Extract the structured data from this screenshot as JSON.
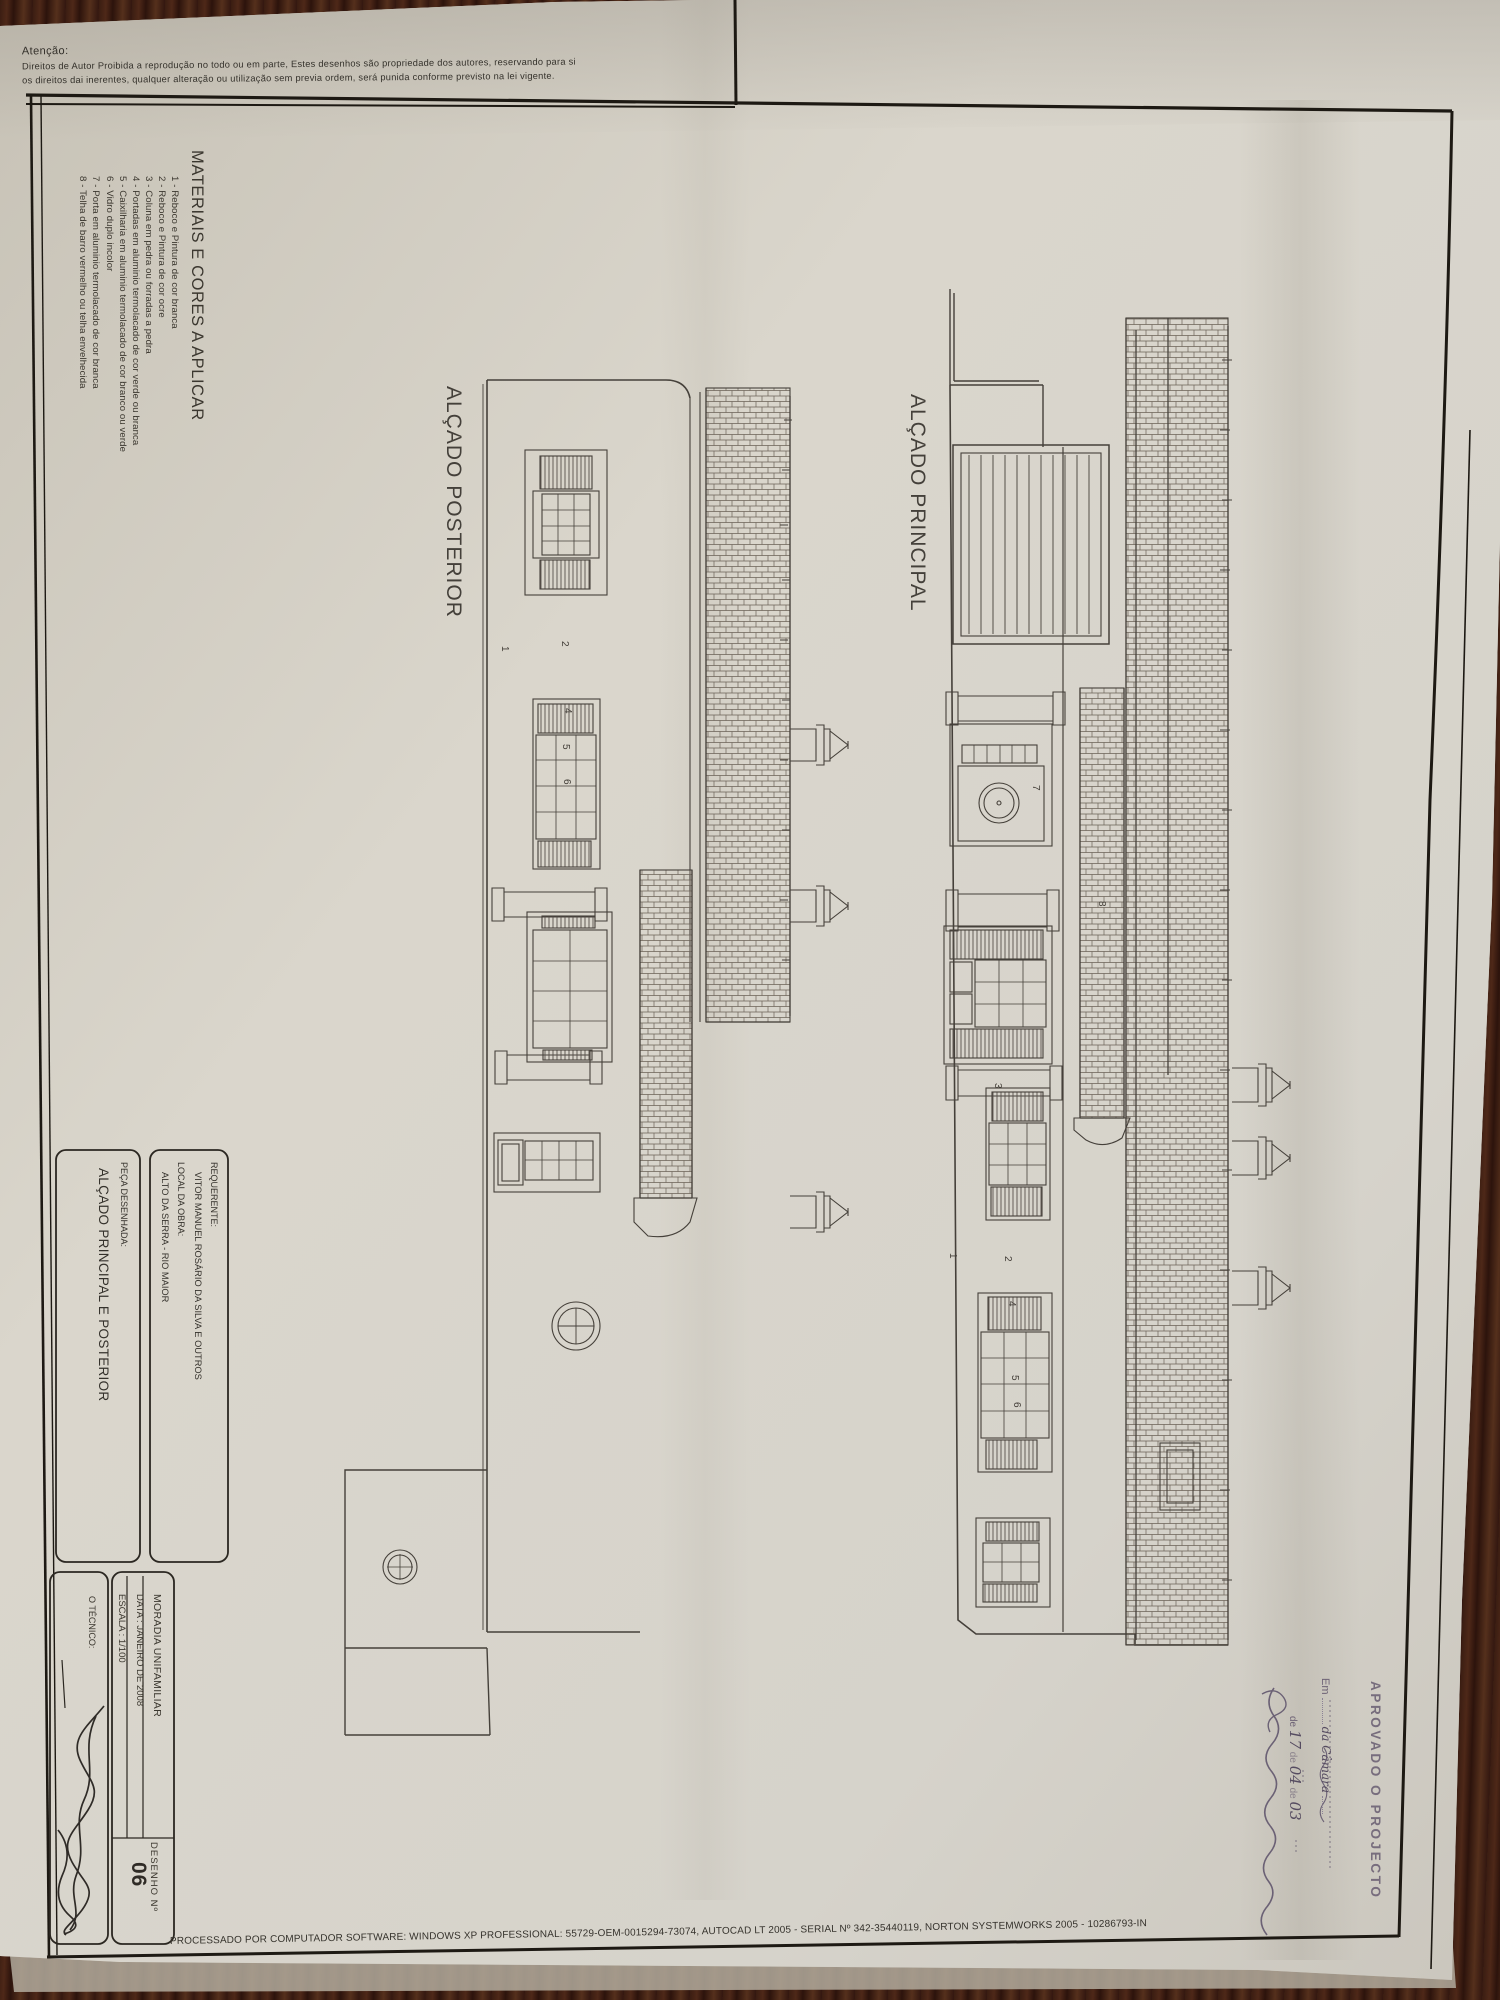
{
  "notice": {
    "heading": "Atenção:",
    "line1": "Direitos de Autor Proibida a reprodução no todo ou em parte, Estes desenhos são propriedade dos autores, reservando para si",
    "line2": "os direitos dai inerentes, qualquer alteração ou utilização sem previa ordem, será punida conforme previsto na lei vigente."
  },
  "materials": {
    "title": "MATERIAIS E CORES A APLICAR",
    "items": [
      "1 - Reboco e Pintura de cor branca",
      "2 - Reboco e Pintura de cor ocre",
      "3 - Coluna em pedra ou forradas a pedra",
      "4 - Portadas em aluminio termolacado de cor verde ou branca",
      "5 - Caixilharia em aluminio termolacado de cor branco ou verde",
      "6 - Vidro duplo incolor",
      "7 - Porta em aluminio termolacado de cor branca",
      "8 - Telha de barro vermelho ou telha envelhecida"
    ]
  },
  "elevations": {
    "posterior_label": "ALÇADO POSTERIOR",
    "principal_label": "ALÇADO PRINCIPAL"
  },
  "drawing_refs": {
    "posterior": [
      "1",
      "2",
      "4",
      "5",
      "6"
    ],
    "principal": [
      "8",
      "7",
      "3",
      "1",
      "2",
      "4",
      "5",
      "6"
    ]
  },
  "stamp": {
    "title": "APROVADO O PROJECTO",
    "em": "Em",
    "camara": "da Câmara",
    "de": "de",
    "d1": "17",
    "d2": "04",
    "d3": "03"
  },
  "title_block": {
    "requerente_label": "REQUERENTE:",
    "requerente_value": "VITOR MANUEL ROSÁRIO DA SILVA E OUTROS",
    "local_label": "LOCAL DA OBRA:",
    "local_value": "ALTO DA SERRA - RIO MAIOR",
    "peca_label": "PEÇA DESENHADA:",
    "peca_value": "ALÇADO PRINCIPAL E POSTERIOR",
    "moradia": "MORADIA UNIFAMILIAR",
    "data": "DATA : JANEIRO DE 2008",
    "escala": "ESCALA : 1/100",
    "tecnico_label": "O TÉCNICO:",
    "desenho_label": "DESENHO  Nº",
    "desenho_value": "06"
  },
  "footer": {
    "processado": "PROCESSADO POR COMPUTADOR SOFTWARE: WINDOWS XP PROFESSIONAL:  55729-OEM-0015294-73074, AUTOCAD LT 2005 - SERIAL Nº  342-35440119, NORTON SYSTEMWORKS 2005 - 10286793-IN"
  },
  "colors": {
    "paper": "#d8d4ca",
    "wood": "#3a1d12",
    "ink": "#3b372f",
    "stamp_ink": "#6e6376"
  }
}
